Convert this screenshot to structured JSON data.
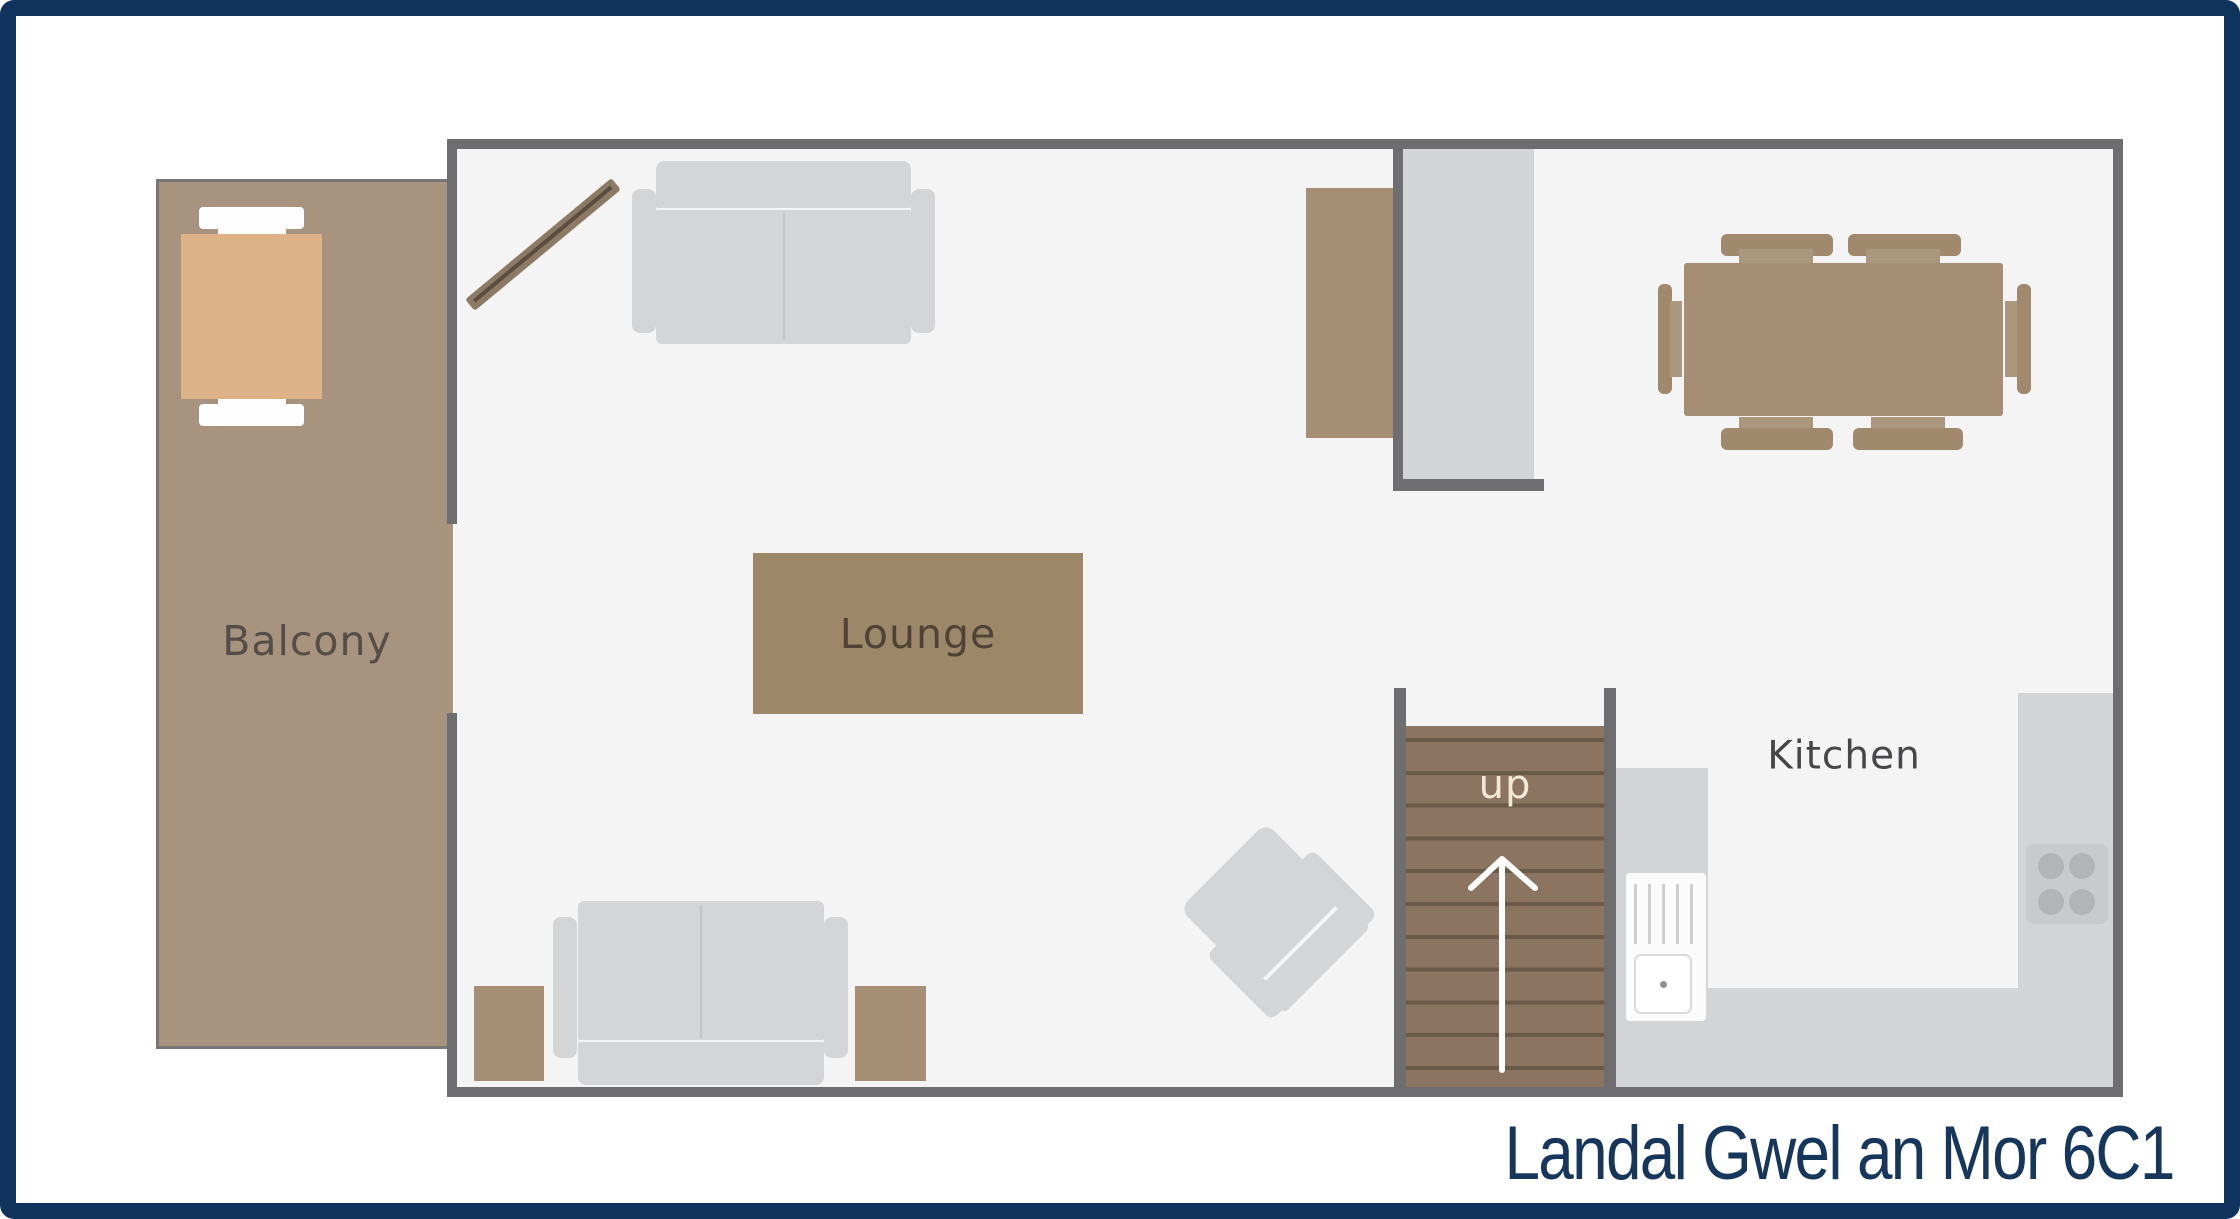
{
  "title": "Landal Gwel an Mor 6C1",
  "plan": {
    "rooms": [
      {
        "id": "balcony",
        "label": "Balcony"
      },
      {
        "id": "lounge",
        "label": "Lounge"
      },
      {
        "id": "kitchen",
        "label": "Kitchen"
      }
    ],
    "stairs": {
      "label": "up",
      "direction_icon": "up-arrow"
    },
    "furniture": [
      "balcony-table",
      "balcony-chair",
      "balcony-chair",
      "wall-tv-diagonal",
      "sofa-3-seat-top",
      "sofa-3-seat-bottom",
      "armchair",
      "side-table",
      "side-table",
      "lounge-rug",
      "sideboard",
      "stair-void",
      "dining-table",
      "dining-chair-x6",
      "kitchen-counter-u-shape",
      "sink-with-drainer",
      "hob-4-ring"
    ]
  },
  "colors": {
    "border_navy": "#10335e",
    "title_navy": "#16365c",
    "wall_gray": "#6e6e71",
    "floor_gray": "#f4f4f5",
    "balcony_brown": "#a8937e",
    "rug_brown": "#9d8769",
    "stairs_brown": "#8b7560",
    "wood_brown": "#a58e74",
    "sofa_gray": "#d4d5d7",
    "counter_gray": "#d3d4d6",
    "balcony_table_tan": "#ddb287",
    "stairs_text_cream": "#f3e8d5"
  }
}
